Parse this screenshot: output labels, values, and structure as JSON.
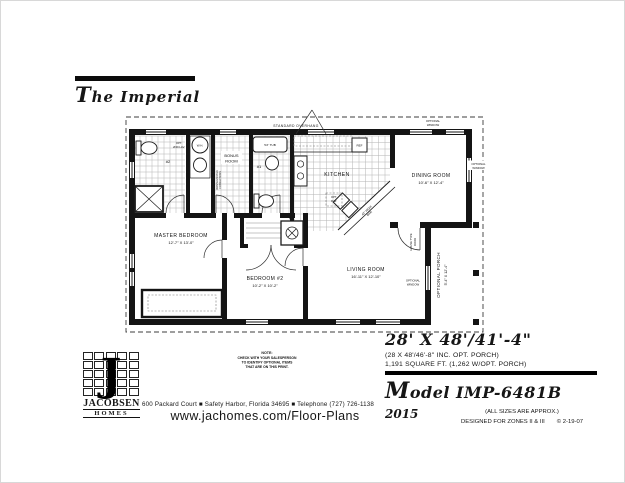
{
  "title": {
    "initial": "T",
    "rest": "he Imperial"
  },
  "plan": {
    "overhang": "STANDARD OVERHANG",
    "optional_window_1": "OPTIONAL",
    "optional_window_2": "WINDOW",
    "rooms": {
      "master_name": "MASTER BEDROOM",
      "master_dims": "12'-7\" X 13'-0\"",
      "bedroom2_name": "BEDROOM #2",
      "bedroom2_dims": "10'-2\" X 10'-2\"",
      "living_name": "LIVING ROOM",
      "living_dims": "16'-11\" X 12'-10\"",
      "dining_name": "DINING ROOM",
      "dining_dims": "10'-6\" X 12'-4\"",
      "kitchen_name": "KITCHEN",
      "bonus_1": "BONUS",
      "bonus_2": "ROOM",
      "porch_name": "OPTIONAL PORCH",
      "porch_dims": "5'-4\" X 12'-4\""
    },
    "fixtures": {
      "tub": "54\" TUB",
      "ref": "REF",
      "wh": "W.H.",
      "opt_lav_1": "OPT.",
      "opt_lav_2": "2ND LAV.",
      "bath1": "#1",
      "bath2": "#2",
      "shelf": "SHELF",
      "wd_1": "WASHER/DRYER",
      "wd_2": "CONNECTIONS",
      "dw_1": "OPT.",
      "dw_2": "D.W.",
      "bar_1": "42\" HIGH",
      "bar_2": "BAR",
      "ac": "A.C.",
      "door_1": "HOUSE TYPE",
      "door_2": "DOOR"
    }
  },
  "specs": {
    "size_main": "28' X 48'/41'-4\"",
    "size_sub1": "(28 X 48'/46'-8\" INC. OPT. PORCH)",
    "size_sub2": "1,191 SQUARE FT. (1,262 W/OPT. PORCH)",
    "model_initial": "M",
    "model_rest": "odel IMP-6481B",
    "year": "2015",
    "approx": "(ALL SIZES ARE APPROX.)",
    "zones": "DESIGNED FOR ZONES II & III",
    "copyright": "© 2-19-07"
  },
  "footer": {
    "logo_letter": "J",
    "logo_word1": "JACOBSEN",
    "logo_word2": "HOMES",
    "note_title": "NOTE:",
    "note_line1": "CHECK WITH YOUR SALESPERSON",
    "note_line2": "TO IDENTIFY OPTIONAL ITEMS",
    "note_line3": "THAT ARE ON THIS PRINT.",
    "address": "600 Packard Court ■ Safety Harbor, Florida 34695 ■ Telephone (727) 726-1138",
    "website": "www.jachomes.com/Floor-Plans"
  }
}
